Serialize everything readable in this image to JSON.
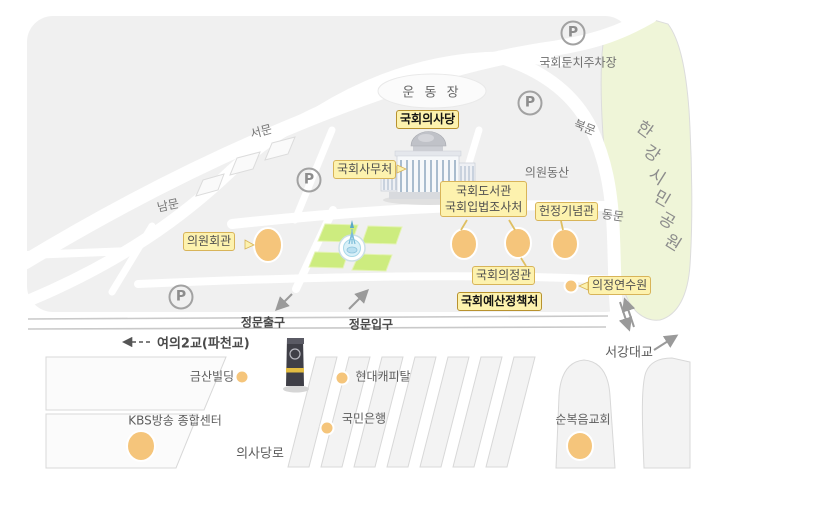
{
  "colors": {
    "label_bg": "#fdf2ae",
    "label_border": "#d8b459",
    "label_border_strong": "#b8922e",
    "building_marker": "#f5c57b",
    "lawn_green": "#cdec7f",
    "park_green": "#eff5d8",
    "map_base": "#f0f0f0",
    "road_white": "#ffffff",
    "monument_dark": "#3f3f47",
    "monument_band": "#e2bc42"
  },
  "symbols": {
    "parking": "P"
  },
  "labels": {
    "stadium": "운 동 장",
    "assembly_hall": "국회의사당",
    "secretariat": "국회사무처",
    "library": "국회도서관",
    "legislation_office": "국회입법조사처",
    "memorial_hall": "헌정기념관",
    "uijeong_hall": "국회의정관",
    "budget_office": "국회예산정책처",
    "members_hall": "의원회관",
    "training_institute": "의정연수원",
    "riverside_parking": "국회둔치주차장",
    "members_hill": "의원동산",
    "main_gate_exit": "정문출구",
    "main_gate_entrance": "정문입구",
    "yeoui_bridge": "여의2교(파천교)",
    "seogang_bridge": "서강대교",
    "geumsan_building": "금산빌딩",
    "hyundai_capital": "현대캐피탈",
    "kbs_center": "KBS방송 종합센터",
    "kookmin_bank": "국민은행",
    "full_gospel_church": "순복음교회",
    "uisadang_road": "의사당로"
  },
  "gates": {
    "west": "서문",
    "south": "남문",
    "north": "북문",
    "east": "동문"
  },
  "park": {
    "name": "한강시민공원",
    "chars": [
      "한",
      "강",
      "시",
      "민",
      "공",
      "원"
    ]
  }
}
